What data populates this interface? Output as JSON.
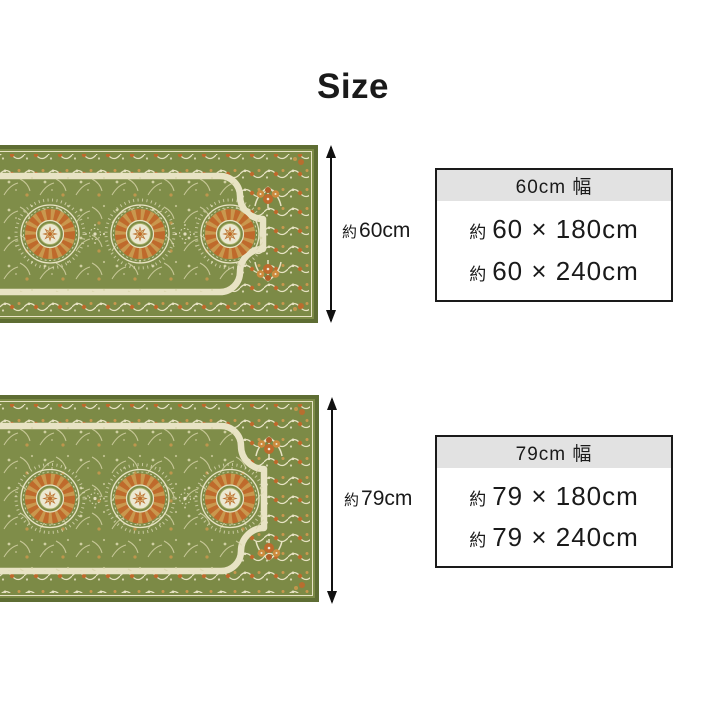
{
  "page": {
    "title": "Size"
  },
  "products": [
    {
      "name": "60cm width runner rug",
      "arrow_label": {
        "approx": "約",
        "value": "60cm"
      },
      "box": {
        "header": "60cm 幅",
        "rows": [
          {
            "approx": "約",
            "value": "60 × 180cm"
          },
          {
            "approx": "約",
            "value": "60 × 240cm"
          }
        ]
      }
    },
    {
      "name": "79cm width runner rug",
      "arrow_label": {
        "approx": "約",
        "value": "79cm"
      },
      "box": {
        "header": "79cm 幅",
        "rows": [
          {
            "approx": "約",
            "value": "79 × 180cm"
          },
          {
            "approx": "約",
            "value": "79 × 240cm"
          }
        ]
      }
    }
  ],
  "colors": {
    "text": "#1a1a1a",
    "box_border": "#1a1a1a",
    "box_header_bg": "#e2e2e2",
    "arrow": "#111111",
    "rug": {
      "edge": "#5e6d33",
      "band": "#7c8a46",
      "field": "#7f8d49",
      "cream": "#e8e3c4",
      "cream2": "#ece8d2",
      "sprig": "#d9d6ab",
      "orange": "#bf6a2c",
      "tan": "#c9984e",
      "star": "#dcc188",
      "star_edge": "#bb6f30",
      "ring_edge": "#a9b168"
    }
  }
}
